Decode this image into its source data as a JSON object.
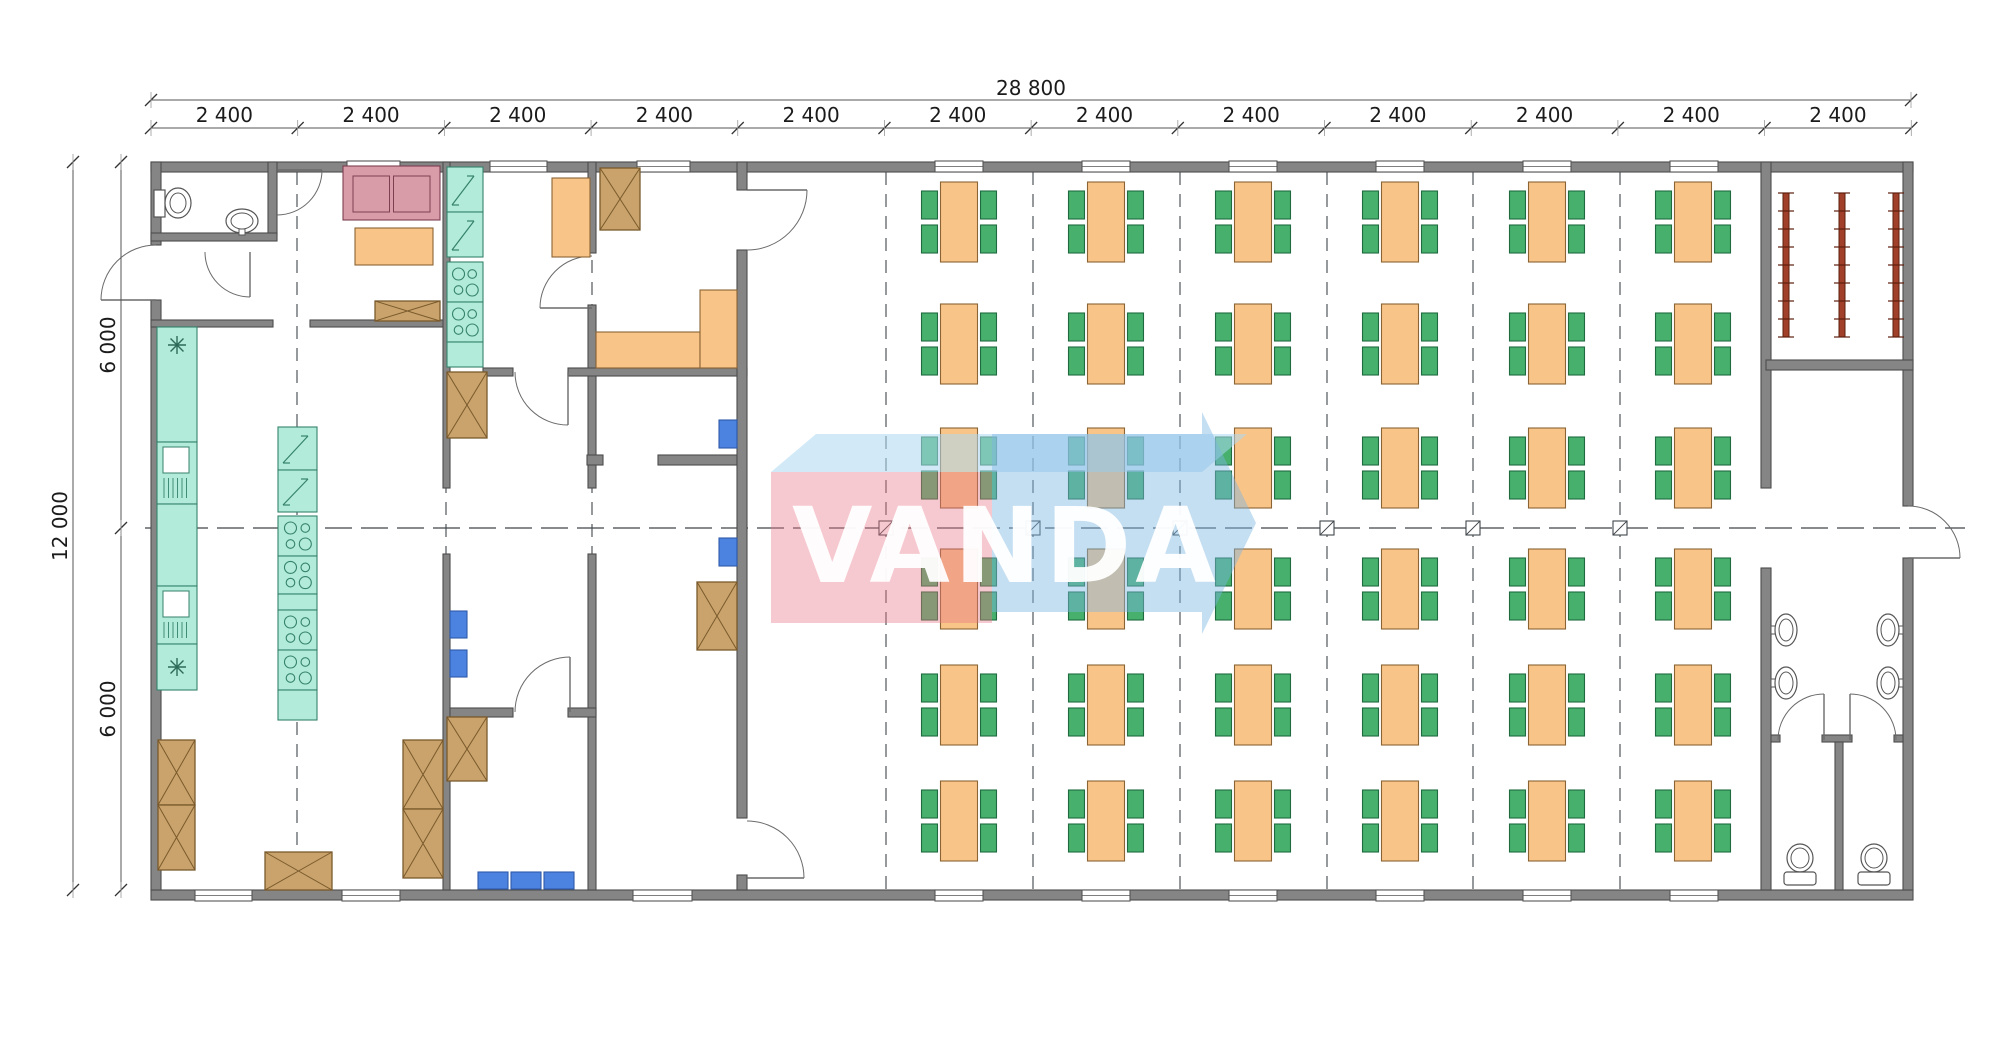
{
  "watermark": {
    "text": "VANDA",
    "pink_box": [
      [
        771,
        472
      ],
      [
        992,
        472
      ],
      [
        992,
        623
      ],
      [
        771,
        623
      ]
    ],
    "top_face": [
      [
        771,
        472
      ],
      [
        816,
        434
      ],
      [
        1247,
        434
      ],
      [
        1202,
        472
      ]
    ],
    "body": [
      [
        992,
        434
      ],
      [
        1202,
        434
      ],
      [
        1202,
        612
      ],
      [
        992,
        612
      ]
    ],
    "head": [
      [
        1202,
        412
      ],
      [
        1256,
        523
      ],
      [
        1202,
        634
      ]
    ]
  },
  "dimensions": {
    "total_width_label": "28 800",
    "module_labels": [
      "2 400",
      "2 400",
      "2 400",
      "2 400",
      "2 400",
      "2 400",
      "2 400",
      "2 400",
      "2 400",
      "2 400",
      "2 400",
      "2 400"
    ],
    "total_height_label": "12 000",
    "height_segments": [
      "6 000",
      "6 000"
    ],
    "px": {
      "x0": 151,
      "x1": 1911,
      "step": 146.69,
      "top_line_y": 100,
      "module_line_y": 128,
      "left_total_x": 73,
      "left_seg_x": 121,
      "y0": 162,
      "ymid": 528,
      "y1": 890
    }
  },
  "colors": {
    "wall": "#858585",
    "wallStroke": "#4c4c4c",
    "line": "#555a5e",
    "dash": "#41464a",
    "orange": "#F9C488",
    "orangeStroke": "#8A6434",
    "green": "#46B06C",
    "greenStroke": "#1F6B3F",
    "blue": "#4C82E0",
    "blueStroke": "#2F5AA8",
    "tan": "#C9A36B",
    "tanStroke": "#7A5A2C",
    "teal": "#B2EBD9",
    "tealStroke": "#35826C",
    "pink": "#D89BA8",
    "pinkStroke": "#7D4050",
    "radiator": "#A0402A",
    "radiatorStroke": "#5E1F0D",
    "fixture": "#FFFFFF",
    "fixtureStroke": "#555555",
    "wmPink": "rgba(232,118,136,0.40)",
    "wmBlue": "rgba(124,181,226,0.45)",
    "wmTop": "rgba(173,216,243,0.55)"
  },
  "plan": {
    "walls": [
      [
        151,
        162,
        1762,
        10
      ],
      [
        151,
        890,
        1762,
        10
      ],
      [
        151,
        162,
        10,
        83
      ],
      [
        151,
        300,
        10,
        590
      ],
      [
        1903,
        162,
        10,
        344
      ],
      [
        1903,
        558,
        10,
        332
      ],
      [
        268,
        162,
        9,
        73
      ],
      [
        151,
        233,
        126,
        8
      ],
      [
        151,
        320,
        122,
        7
      ],
      [
        310,
        320,
        140,
        7
      ],
      [
        443,
        162,
        7,
        326
      ],
      [
        443,
        554,
        7,
        336
      ],
      [
        588,
        162,
        8,
        91
      ],
      [
        588,
        305,
        8,
        183
      ],
      [
        588,
        554,
        8,
        336
      ],
      [
        483,
        368,
        30,
        8
      ],
      [
        568,
        368,
        179,
        8
      ],
      [
        587,
        455,
        16,
        10
      ],
      [
        658,
        455,
        79,
        10
      ],
      [
        450,
        708,
        63,
        9
      ],
      [
        568,
        708,
        28,
        9
      ],
      [
        737,
        162,
        10,
        28
      ],
      [
        737,
        250,
        10,
        568
      ],
      [
        737,
        875,
        10,
        15
      ],
      [
        1761,
        162,
        10,
        326
      ],
      [
        1761,
        568,
        10,
        322
      ],
      [
        1766,
        360,
        147,
        10
      ],
      [
        1771,
        735,
        9,
        7
      ],
      [
        1822,
        735,
        30,
        7
      ],
      [
        1894,
        735,
        9,
        7
      ],
      [
        1835,
        742,
        8,
        148
      ]
    ],
    "windows_top": [
      [
        347,
        53
      ],
      [
        490,
        57
      ],
      [
        637,
        53
      ],
      [
        935,
        48
      ],
      [
        1082,
        48
      ],
      [
        1229,
        48
      ],
      [
        1376,
        48
      ],
      [
        1523,
        48
      ],
      [
        1670,
        48
      ]
    ],
    "windows_bottom": [
      [
        195,
        57
      ],
      [
        342,
        58
      ],
      [
        633,
        59
      ],
      [
        935,
        48
      ],
      [
        1082,
        48
      ],
      [
        1229,
        48
      ],
      [
        1376,
        48
      ],
      [
        1523,
        48
      ],
      [
        1670,
        48
      ]
    ],
    "dashed_vertical": [
      [
        297,
        172,
        890
      ],
      [
        446,
        172,
        890
      ],
      [
        592,
        172,
        890
      ],
      [
        886,
        172,
        890
      ],
      [
        1033,
        172,
        890
      ],
      [
        1180,
        172,
        890
      ],
      [
        1327,
        172,
        890
      ],
      [
        1473,
        172,
        890
      ],
      [
        1620,
        172,
        890
      ]
    ],
    "centerline": {
      "y": 528,
      "x1": 145,
      "x2": 1965
    },
    "grid_squares": {
      "y": 528,
      "xs": [
        886,
        1033,
        1180,
        1327,
        1473,
        1620
      ],
      "size": 14
    },
    "doors": [
      {
        "hx": 156,
        "hy": 300,
        "r": 55,
        "a0": -90,
        "a1": 180,
        "sweep": 0
      },
      {
        "hx": 277,
        "hy": 170,
        "r": 45,
        "a0": 90,
        "a1": 0,
        "sweep": 0
      },
      {
        "hx": 250,
        "hy": 252,
        "r": 45,
        "a0": 180,
        "a1": 90,
        "sweep": 0
      },
      {
        "hx": 592,
        "hy": 308,
        "r": 52,
        "a0": -90,
        "a1": 180,
        "sweep": 0
      },
      {
        "hx": 747,
        "hy": 190,
        "r": 60,
        "a0": 90,
        "a1": 0,
        "sweep": 0
      },
      {
        "hx": 568,
        "hy": 372,
        "r": 53,
        "a0": 180,
        "a1": 90,
        "sweep": 0
      },
      {
        "hx": 570,
        "hy": 712,
        "r": 55,
        "a0": 180,
        "a1": 270,
        "sweep": 1
      },
      {
        "hx": 747,
        "hy": 878,
        "r": 57,
        "a0": 270,
        "a1": 360,
        "sweep": 1
      },
      {
        "hx": 1908,
        "hy": 558,
        "r": 52,
        "a0": 270,
        "a1": 360,
        "sweep": 1
      },
      {
        "hx": 1824,
        "hy": 740,
        "r": 46,
        "a0": 180,
        "a1": 270,
        "sweep": 1
      },
      {
        "hx": 1850,
        "hy": 740,
        "r": 46,
        "a0": 0,
        "a1": -90,
        "sweep": 0
      }
    ],
    "dining": {
      "cols": [
        959,
        1106,
        1253,
        1400,
        1547,
        1693
      ],
      "rows": [
        222,
        344,
        468,
        589,
        705,
        821
      ],
      "table": {
        "w": 37,
        "h": 80
      },
      "chair": {
        "w": 16,
        "h": 28
      }
    },
    "radiators": {
      "xs": [
        1786,
        1842,
        1896
      ],
      "y1": 193,
      "y2": 337,
      "ticks": 9
    },
    "furniture": [
      {
        "t": "toilet-side",
        "x": 154,
        "y": 186
      },
      {
        "t": "basin-ped",
        "x": 242,
        "y": 221
      },
      {
        "t": "sofa",
        "x": 343,
        "y": 166,
        "w": 97,
        "h": 54
      },
      {
        "t": "table",
        "x": 355,
        "y": 228,
        "w": 78,
        "h": 37
      },
      {
        "t": "crate",
        "x": 375,
        "y": 301,
        "w": 65,
        "h": 20
      },
      {
        "t": "fridge",
        "x": 447,
        "y": 167,
        "w": 36,
        "h": 45
      },
      {
        "t": "fridge",
        "x": 447,
        "y": 212,
        "w": 36,
        "h": 45
      },
      {
        "t": "cooktop",
        "x": 447,
        "y": 262,
        "w": 36,
        "h": 40
      },
      {
        "t": "cooktop",
        "x": 447,
        "y": 302,
        "w": 36,
        "h": 40
      },
      {
        "t": "teal",
        "x": 447,
        "y": 342,
        "w": 36,
        "h": 25
      },
      {
        "t": "table",
        "x": 552,
        "y": 178,
        "w": 38,
        "h": 79
      },
      {
        "t": "crate",
        "x": 600,
        "y": 168,
        "w": 40,
        "h": 62
      },
      {
        "t": "table",
        "x": 596,
        "y": 332,
        "w": 104,
        "h": 36
      },
      {
        "t": "table",
        "x": 700,
        "y": 290,
        "w": 37,
        "h": 78
      },
      {
        "t": "crate",
        "x": 447,
        "y": 372,
        "w": 40,
        "h": 66
      },
      {
        "t": "teal",
        "x": 157,
        "y": 327,
        "w": 40,
        "h": 115
      },
      {
        "t": "sink",
        "x": 157,
        "y": 442,
        "w": 40,
        "h": 62
      },
      {
        "t": "teal",
        "x": 157,
        "y": 504,
        "w": 40,
        "h": 82
      },
      {
        "t": "sink",
        "x": 157,
        "y": 586,
        "w": 40,
        "h": 58
      },
      {
        "t": "teal",
        "x": 157,
        "y": 644,
        "w": 40,
        "h": 46
      },
      {
        "t": "star",
        "x": 177,
        "y": 345
      },
      {
        "t": "star",
        "x": 177,
        "y": 667
      },
      {
        "t": "fridge",
        "x": 278,
        "y": 427,
        "w": 39,
        "h": 43
      },
      {
        "t": "fridge",
        "x": 278,
        "y": 470,
        "w": 39,
        "h": 42
      },
      {
        "t": "cooktop",
        "x": 278,
        "y": 516,
        "w": 39,
        "h": 40
      },
      {
        "t": "cooktop",
        "x": 278,
        "y": 556,
        "w": 39,
        "h": 38
      },
      {
        "t": "teal",
        "x": 278,
        "y": 594,
        "w": 39,
        "h": 16
      },
      {
        "t": "cooktop",
        "x": 278,
        "y": 610,
        "w": 39,
        "h": 40
      },
      {
        "t": "cooktop",
        "x": 278,
        "y": 650,
        "w": 39,
        "h": 40
      },
      {
        "t": "teal",
        "x": 278,
        "y": 690,
        "w": 39,
        "h": 30
      },
      {
        "t": "crate",
        "x": 158,
        "y": 740,
        "w": 37,
        "h": 65
      },
      {
        "t": "crate",
        "x": 158,
        "y": 805,
        "w": 37,
        "h": 65
      },
      {
        "t": "crate",
        "x": 265,
        "y": 852,
        "w": 67,
        "h": 38
      },
      {
        "t": "crate",
        "x": 403,
        "y": 740,
        "w": 40,
        "h": 69
      },
      {
        "t": "crate",
        "x": 403,
        "y": 809,
        "w": 40,
        "h": 69
      },
      {
        "t": "crate",
        "x": 447,
        "y": 717,
        "w": 40,
        "h": 64
      },
      {
        "t": "chairB",
        "x": 478,
        "y": 872,
        "w": 30,
        "h": 17
      },
      {
        "t": "chairB",
        "x": 511,
        "y": 872,
        "w": 30,
        "h": 17
      },
      {
        "t": "chairB",
        "x": 544,
        "y": 872,
        "w": 30,
        "h": 17
      },
      {
        "t": "chairB",
        "x": 450,
        "y": 611,
        "w": 17,
        "h": 27
      },
      {
        "t": "chairB",
        "x": 450,
        "y": 650,
        "w": 17,
        "h": 27
      },
      {
        "t": "chairB",
        "x": 719,
        "y": 420,
        "w": 18,
        "h": 28
      },
      {
        "t": "chairB",
        "x": 719,
        "y": 538,
        "w": 18,
        "h": 28
      },
      {
        "t": "crate",
        "x": 697,
        "y": 582,
        "w": 40,
        "h": 68
      },
      {
        "t": "basin-left",
        "x": 1771,
        "y": 613
      },
      {
        "t": "basin-left",
        "x": 1771,
        "y": 666
      },
      {
        "t": "basin-right",
        "x": 1903,
        "y": 613
      },
      {
        "t": "basin-right",
        "x": 1903,
        "y": 666
      },
      {
        "t": "toilet-up",
        "x": 1800,
        "y": 868
      },
      {
        "t": "toilet-up",
        "x": 1874,
        "y": 868
      }
    ]
  }
}
